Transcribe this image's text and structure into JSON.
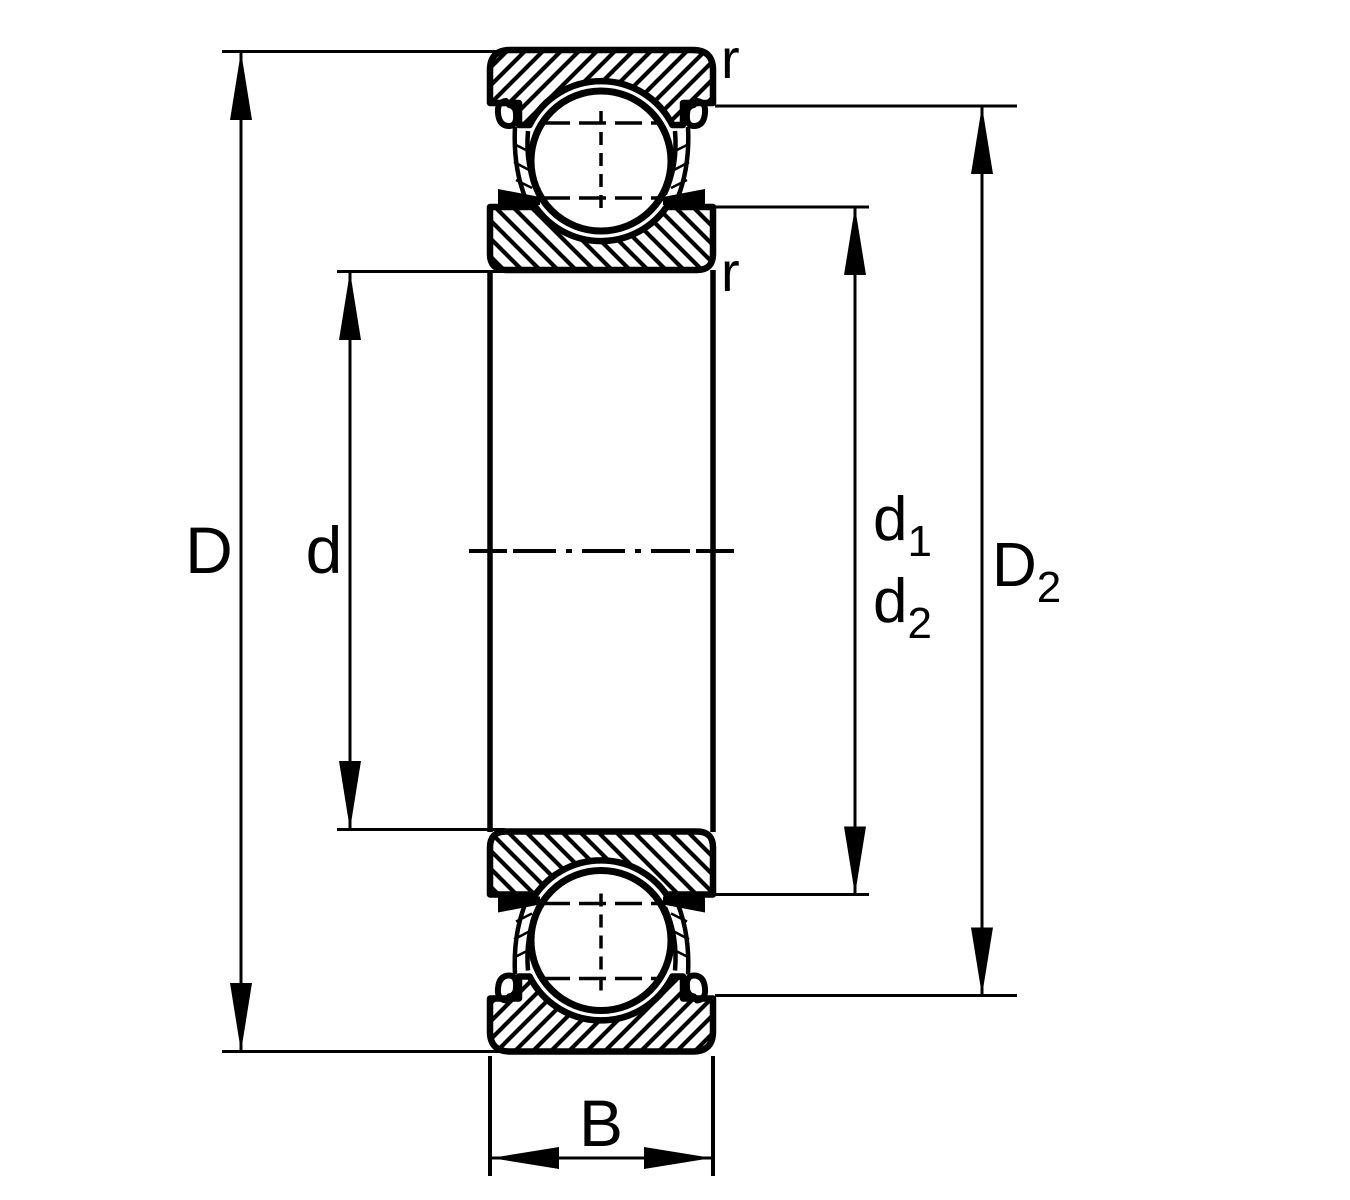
{
  "drawing": {
    "type": "ball-bearing-cross-section",
    "labels": {
      "outer_diameter": "D",
      "bore_diameter": "d",
      "d1": {
        "base": "d",
        "sub": "1"
      },
      "d2": {
        "base": "d",
        "sub": "2"
      },
      "D2": {
        "base": "D",
        "sub": "2"
      },
      "width": "B",
      "chamfer_top": "r",
      "chamfer_bottom": "r"
    },
    "colors": {
      "line": "#000000",
      "background": "#ffffff"
    }
  }
}
